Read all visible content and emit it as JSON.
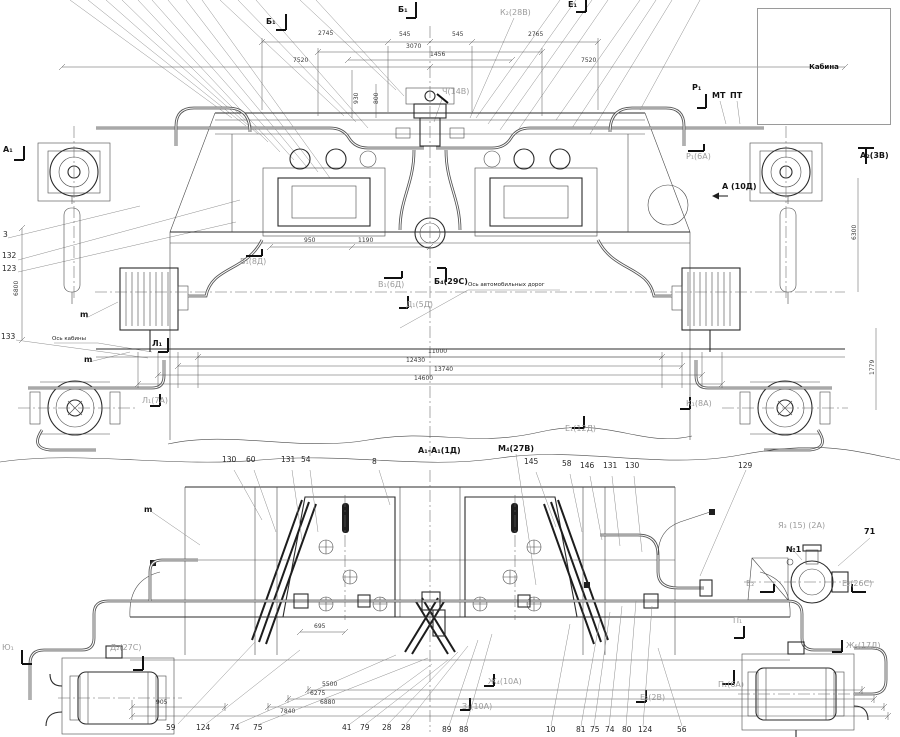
{
  "cabin_label": "Кабина",
  "annotations": {
    "section_markers": [
      {
        "text": "Б₁",
        "x": 266,
        "y": 18
      },
      {
        "text": "Б₁",
        "x": 398,
        "y": 6
      },
      {
        "text": "Е₁",
        "x": 568,
        "y": 1
      },
      {
        "text": "А₁",
        "x": 3,
        "y": 146
      },
      {
        "text": "А₂(3В)",
        "x": 860,
        "y": 152
      },
      {
        "text": "А (10Д)",
        "x": 722,
        "y": 183
      },
      {
        "text": "Л₁",
        "x": 152,
        "y": 340
      },
      {
        "text": "Б₄(29С)",
        "x": 434,
        "y": 278
      },
      {
        "text": "А₁-А₁(1Д)",
        "x": 418,
        "y": 447
      },
      {
        "text": "М₄(27В)",
        "x": 498,
        "y": 445
      },
      {
        "text": "Р₁",
        "x": 692,
        "y": 84
      },
      {
        "text": "МТ",
        "x": 712,
        "y": 92
      },
      {
        "text": "ПТ",
        "x": 730,
        "y": 92
      },
      {
        "text": "m",
        "x": 80,
        "y": 311
      },
      {
        "text": "m",
        "x": 84,
        "y": 356
      },
      {
        "text": "m",
        "x": 144,
        "y": 506
      },
      {
        "text": "№1",
        "x": 786,
        "y": 546
      },
      {
        "text": "71",
        "x": 864,
        "y": 528
      }
    ],
    "reference_labels": [
      {
        "text": "К₂(28В)",
        "x": 500,
        "y": 9
      },
      {
        "text": "Ч(14В)",
        "x": 442,
        "y": 88
      },
      {
        "text": "Р₁(6А)",
        "x": 686,
        "y": 153
      },
      {
        "text": "Б₁(8Д)",
        "x": 240,
        "y": 258
      },
      {
        "text": "В₁(6Д)",
        "x": 378,
        "y": 281
      },
      {
        "text": "Д₁(5Д)",
        "x": 406,
        "y": 301
      },
      {
        "text": "Л₁(7А)",
        "x": 142,
        "y": 397
      },
      {
        "text": "К₁(8А)",
        "x": 686,
        "y": 400
      },
      {
        "text": "Е₁(12Д)",
        "x": 565,
        "y": 425
      },
      {
        "text": "Я₃ (15) (2А)",
        "x": 778,
        "y": 522
      },
      {
        "text": "Е₂",
        "x": 746,
        "y": 580
      },
      {
        "text": "Е₂(26С)",
        "x": 842,
        "y": 580
      },
      {
        "text": "Д₂(27С)",
        "x": 110,
        "y": 644
      },
      {
        "text": "Ю₁",
        "x": 2,
        "y": 644
      },
      {
        "text": "Ж₅(17Д)",
        "x": 846,
        "y": 642
      },
      {
        "text": "П₁",
        "x": 733,
        "y": 617
      },
      {
        "text": "П₁(6А)",
        "x": 718,
        "y": 681
      },
      {
        "text": "Е₂(2В)",
        "x": 640,
        "y": 694
      },
      {
        "text": "Ж₄(10А)",
        "x": 488,
        "y": 678
      },
      {
        "text": "З₁(10А)",
        "x": 462,
        "y": 703
      }
    ],
    "part_callouts": [
      {
        "text": "3",
        "x": 3,
        "y": 231
      },
      {
        "text": "132",
        "x": 2,
        "y": 252
      },
      {
        "text": "123",
        "x": 2,
        "y": 265
      },
      {
        "text": "133",
        "x": 1,
        "y": 333
      },
      {
        "text": "130",
        "x": 222,
        "y": 456
      },
      {
        "text": "60",
        "x": 246,
        "y": 456
      },
      {
        "text": "131",
        "x": 281,
        "y": 456
      },
      {
        "text": "54",
        "x": 301,
        "y": 456
      },
      {
        "text": "8",
        "x": 372,
        "y": 458
      },
      {
        "text": "145",
        "x": 524,
        "y": 458
      },
      {
        "text": "58",
        "x": 562,
        "y": 460
      },
      {
        "text": "146",
        "x": 580,
        "y": 462
      },
      {
        "text": "131",
        "x": 603,
        "y": 462
      },
      {
        "text": "130",
        "x": 625,
        "y": 462
      },
      {
        "text": "129",
        "x": 738,
        "y": 462
      },
      {
        "text": "59",
        "x": 166,
        "y": 724
      },
      {
        "text": "124",
        "x": 196,
        "y": 724
      },
      {
        "text": "74",
        "x": 230,
        "y": 724
      },
      {
        "text": "75",
        "x": 253,
        "y": 724
      },
      {
        "text": "41",
        "x": 342,
        "y": 724
      },
      {
        "text": "79",
        "x": 360,
        "y": 724
      },
      {
        "text": "28",
        "x": 382,
        "y": 724
      },
      {
        "text": "28",
        "x": 401,
        "y": 724
      },
      {
        "text": "89",
        "x": 442,
        "y": 726
      },
      {
        "text": "88",
        "x": 459,
        "y": 726
      },
      {
        "text": "10",
        "x": 546,
        "y": 726
      },
      {
        "text": "81",
        "x": 576,
        "y": 726
      },
      {
        "text": "75",
        "x": 590,
        "y": 726
      },
      {
        "text": "74",
        "x": 605,
        "y": 726
      },
      {
        "text": "80",
        "x": 622,
        "y": 726
      },
      {
        "text": "124",
        "x": 638,
        "y": 726
      },
      {
        "text": "56",
        "x": 677,
        "y": 726
      }
    ],
    "dimensions": [
      {
        "text": "2745",
        "x": 318,
        "y": 31
      },
      {
        "text": "545",
        "x": 399,
        "y": 32
      },
      {
        "text": "545",
        "x": 452,
        "y": 32
      },
      {
        "text": "2765",
        "x": 528,
        "y": 32
      },
      {
        "text": "3070",
        "x": 406,
        "y": 44
      },
      {
        "text": "1456",
        "x": 430,
        "y": 52
      },
      {
        "text": "7520",
        "x": 293,
        "y": 58
      },
      {
        "text": "7520",
        "x": 581,
        "y": 58
      },
      {
        "text": "950",
        "x": 304,
        "y": 238
      },
      {
        "text": "1190",
        "x": 358,
        "y": 238
      },
      {
        "text": "11000",
        "x": 428,
        "y": 349
      },
      {
        "text": "12430",
        "x": 406,
        "y": 358
      },
      {
        "text": "13740",
        "x": 434,
        "y": 367
      },
      {
        "text": "14600",
        "x": 414,
        "y": 376
      },
      {
        "text": "695",
        "x": 314,
        "y": 624
      },
      {
        "text": "905",
        "x": 156,
        "y": 700
      },
      {
        "text": "5500",
        "x": 322,
        "y": 682
      },
      {
        "text": "6275",
        "x": 310,
        "y": 691
      },
      {
        "text": "6880",
        "x": 320,
        "y": 700
      },
      {
        "text": "7840",
        "x": 280,
        "y": 709
      },
      {
        "text": "6800",
        "x": 14,
        "y": 296,
        "rot": true
      },
      {
        "text": "6300",
        "x": 852,
        "y": 240,
        "rot": true
      },
      {
        "text": "1779",
        "x": 870,
        "y": 375,
        "rot": true
      },
      {
        "text": "930",
        "x": 354,
        "y": 104,
        "rot": true
      },
      {
        "text": "800",
        "x": 374,
        "y": 104,
        "rot": true
      }
    ],
    "notes": [
      {
        "text": "Ось автомобильных дорог",
        "x": 468,
        "y": 283
      },
      {
        "text": "Ось кабины",
        "x": 52,
        "y": 337
      }
    ]
  }
}
